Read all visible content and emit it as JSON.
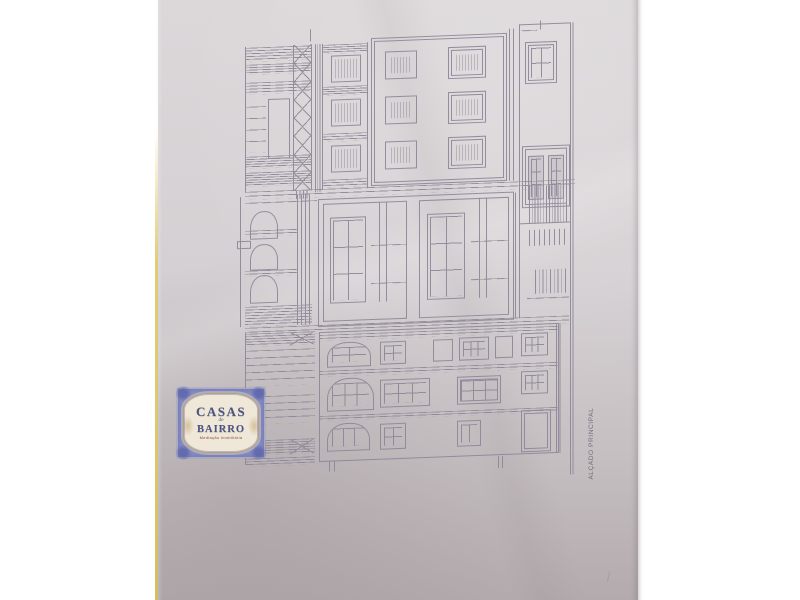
{
  "colors": {
    "background": "#ffffff",
    "paper_top": "#dcd8da",
    "paper_bottom": "#b1a9ab",
    "yellow": "#e2cd77",
    "line": "#8f8798",
    "label_text": "#6d6775",
    "stamp_frame": "#8a8fc2",
    "stamp_corner": "#5d66ab",
    "stamp_panel": "#efe8d8",
    "stamp_gold": "#bfa067",
    "stamp_text": "#4d5480",
    "stamp_tagline": "#8a4a40"
  },
  "stamp": {
    "title": "CASAS",
    "conjunction": "do",
    "subtitle": "BAIRRO",
    "tagline": "Mediação Imobiliária"
  },
  "drawing": {
    "label": "ALÇADO PRINCIPAL",
    "elements": [
      {
        "t": "box",
        "x": 2,
        "y": 2,
        "w": 70,
        "h": 146,
        "sides": "l"
      },
      {
        "t": "hl",
        "x": 2,
        "y": 3,
        "w": 66,
        "h": 14,
        "n": 5
      },
      {
        "t": "hl",
        "x": 2,
        "y": 20,
        "w": 66,
        "h": 10,
        "n": 4
      },
      {
        "t": "hl",
        "x": 2,
        "y": 38,
        "w": 66,
        "h": 12,
        "n": 4
      },
      {
        "t": "box",
        "x": 25,
        "y": 55,
        "w": 22,
        "h": 60
      },
      {
        "t": "hl",
        "x": 2,
        "y": 62,
        "w": 21,
        "h": 46,
        "n": 4
      },
      {
        "t": "hl",
        "x": 2,
        "y": 112,
        "w": 66,
        "h": 12,
        "n": 5
      },
      {
        "t": "hl",
        "x": 2,
        "y": 128,
        "w": 66,
        "h": 14,
        "n": 6
      },
      {
        "t": "x",
        "x": 50,
        "y": 2,
        "w": 19,
        "h": 146,
        "n": 8,
        "sides": "lr"
      },
      {
        "t": "vl",
        "x": 72,
        "y": 2,
        "w": 7,
        "h": 148,
        "n": 3
      },
      {
        "t": "vl",
        "x": 67,
        "y": -13,
        "w": 1,
        "h": 12,
        "n": 1
      },
      {
        "t": "box",
        "x": 79,
        "y": 2,
        "w": 46,
        "h": 146,
        "sides": "lr"
      },
      {
        "t": "hl",
        "x": 79,
        "y": 3,
        "w": 46,
        "h": 9,
        "n": 4
      },
      {
        "t": "box",
        "x": 88,
        "y": 14,
        "w": 30,
        "h": 27,
        "hv": 3,
        "pad": 3
      },
      {
        "t": "hl",
        "x": 79,
        "y": 45,
        "w": 46,
        "h": 9,
        "n": 4
      },
      {
        "t": "box",
        "x": 88,
        "y": 58,
        "w": 30,
        "h": 27,
        "hv": 3,
        "pad": 3
      },
      {
        "t": "hl",
        "x": 79,
        "y": 92,
        "w": 46,
        "h": 8,
        "n": 3
      },
      {
        "t": "box",
        "x": 88,
        "y": 104,
        "w": 30,
        "h": 27,
        "hv": 3,
        "pad": 3
      },
      {
        "t": "hl",
        "x": 79,
        "y": 138,
        "w": 46,
        "h": 8,
        "n": 3
      },
      {
        "t": "box",
        "x": 128,
        "y": -2,
        "w": 136,
        "h": 148,
        "dbl": 1
      },
      {
        "t": "box",
        "x": 142,
        "y": 12,
        "w": 32,
        "h": 28,
        "hv": 3,
        "pad": 5
      },
      {
        "t": "box",
        "x": 205,
        "y": 10,
        "w": 38,
        "h": 32,
        "dbl": 1,
        "hv": 3,
        "pad": 7
      },
      {
        "t": "box",
        "x": 142,
        "y": 57,
        "w": 32,
        "h": 28,
        "hv": 3,
        "pad": 5
      },
      {
        "t": "box",
        "x": 205,
        "y": 55,
        "w": 38,
        "h": 32,
        "dbl": 1,
        "hv": 3,
        "pad": 7
      },
      {
        "t": "box",
        "x": 142,
        "y": 102,
        "w": 32,
        "h": 28,
        "hv": 3,
        "pad": 5
      },
      {
        "t": "box",
        "x": 205,
        "y": 100,
        "w": 38,
        "h": 32,
        "dbl": 1,
        "hv": 3,
        "pad": 7
      },
      {
        "t": "vl",
        "x": 266,
        "y": -6,
        "w": 8,
        "h": 152,
        "n": 2
      },
      {
        "t": "box",
        "x": 276,
        "y": -10,
        "w": 52,
        "h": 200,
        "sides": "ltb"
      },
      {
        "t": "hl",
        "x": 278,
        "y": -4,
        "w": 16,
        "h": 1,
        "n": 1
      },
      {
        "t": "vl",
        "x": 297,
        "y": -13,
        "w": 1,
        "h": 9,
        "n": 1
      },
      {
        "t": "box",
        "x": 282,
        "y": 8,
        "w": 32,
        "h": 42,
        "dbl": 1,
        "cols": 2,
        "rows": 2,
        "pad": 5
      },
      {
        "t": "box",
        "x": 279,
        "y": 112,
        "w": 48,
        "h": 62,
        "dbl": 1
      },
      {
        "t": "box",
        "x": 285,
        "y": 122,
        "w": 16,
        "h": 44,
        "cols": 2,
        "rows": 3,
        "bg": 1
      },
      {
        "t": "box",
        "x": 305,
        "y": 122,
        "w": 16,
        "h": 44,
        "cols": 2,
        "rows": 3,
        "bg": 1
      },
      {
        "t": "vl",
        "x": 327,
        "y": -10,
        "w": 5,
        "h": 452,
        "n": 2
      },
      {
        "t": "hl",
        "x": 2,
        "y": 147,
        "w": 330,
        "h": 8,
        "n": 2
      },
      {
        "t": "vl",
        "x": 53,
        "y": 148,
        "w": 14,
        "h": 8,
        "n": 4
      },
      {
        "t": "hl",
        "x": 2,
        "y": 158,
        "w": 72,
        "h": 1,
        "n": 1
      },
      {
        "t": "arch",
        "x": 7,
        "y": 167,
        "w": 28,
        "h": 28
      },
      {
        "t": "box",
        "x": -6,
        "y": 196,
        "w": 14,
        "h": 8
      },
      {
        "t": "arch",
        "x": 7,
        "y": 200,
        "w": 28,
        "h": 26
      },
      {
        "t": "arch",
        "x": 7,
        "y": 231,
        "w": 28,
        "h": 28
      },
      {
        "t": "hl",
        "x": 2,
        "y": 186,
        "w": 52,
        "h": 6,
        "n": 2
      },
      {
        "t": "hl",
        "x": 2,
        "y": 226,
        "w": 52,
        "h": 6,
        "n": 2
      },
      {
        "t": "hl",
        "x": 2,
        "y": 262,
        "w": 67,
        "h": 20,
        "n": 7
      },
      {
        "t": "vl",
        "x": 54,
        "y": 152,
        "w": 16,
        "h": 130,
        "n": 4
      },
      {
        "t": "vl",
        "x": -3,
        "y": 152,
        "w": 1,
        "h": 130,
        "n": 1
      },
      {
        "t": "box",
        "x": 75,
        "y": 157,
        "w": 196,
        "h": 128
      },
      {
        "t": "box",
        "x": 80,
        "y": 162,
        "w": 84,
        "h": 118
      },
      {
        "t": "box",
        "x": 87,
        "y": 176,
        "w": 36,
        "h": 86,
        "cols": 2,
        "rows": 3
      },
      {
        "t": "vl",
        "x": 136,
        "y": 162,
        "w": 14,
        "h": 100,
        "n": 2
      },
      {
        "t": "hl",
        "x": 128,
        "y": 205,
        "w": 36,
        "h": 1,
        "n": 1
      },
      {
        "t": "hl",
        "x": 128,
        "y": 243,
        "w": 36,
        "h": 1,
        "n": 1
      },
      {
        "t": "box",
        "x": 176,
        "y": 162,
        "w": 90,
        "h": 118
      },
      {
        "t": "box",
        "x": 184,
        "y": 176,
        "w": 38,
        "h": 86,
        "cols": 2,
        "rows": 3
      },
      {
        "t": "vl",
        "x": 236,
        "y": 162,
        "w": 14,
        "h": 100,
        "n": 2
      },
      {
        "t": "hl",
        "x": 228,
        "y": 205,
        "w": 38,
        "h": 1,
        "n": 1
      },
      {
        "t": "hl",
        "x": 228,
        "y": 243,
        "w": 38,
        "h": 1,
        "n": 1
      },
      {
        "t": "vl",
        "x": 272,
        "y": 158,
        "w": 8,
        "h": 126,
        "n": 2
      },
      {
        "t": "vl",
        "x": 286,
        "y": 152,
        "w": 40,
        "h": 38,
        "n": 14
      },
      {
        "t": "vl",
        "x": 286,
        "y": 196,
        "w": 40,
        "h": 16,
        "n": 8
      },
      {
        "t": "vl",
        "x": 292,
        "y": 236,
        "w": 34,
        "h": 24,
        "n": 9
      },
      {
        "t": "hl",
        "x": 284,
        "y": 264,
        "w": 42,
        "h": 1,
        "n": 1
      },
      {
        "t": "hl",
        "x": 2,
        "y": 283,
        "w": 324,
        "h": 8,
        "n": 2
      },
      {
        "t": "box",
        "x": 2,
        "y": 288,
        "w": 70,
        "h": 132,
        "sides": "l"
      },
      {
        "t": "hl",
        "x": 2,
        "y": 289,
        "w": 70,
        "h": 13,
        "n": 5
      },
      {
        "t": "x",
        "x": 47,
        "y": 289,
        "w": 24,
        "h": 13,
        "n": 1
      },
      {
        "t": "hl",
        "x": 2,
        "y": 306,
        "w": 70,
        "h": 36,
        "n": 5
      },
      {
        "t": "hl",
        "x": 2,
        "y": 352,
        "w": 70,
        "h": 28,
        "n": 4
      },
      {
        "t": "hl",
        "x": 2,
        "y": 396,
        "w": 70,
        "h": 15,
        "n": 6
      },
      {
        "t": "x",
        "x": 47,
        "y": 396,
        "w": 24,
        "h": 15,
        "n": 1
      },
      {
        "t": "hl",
        "x": 2,
        "y": 414,
        "w": 70,
        "h": 8,
        "n": 3
      },
      {
        "t": "box",
        "x": 76,
        "y": 290,
        "w": 240,
        "h": 130
      },
      {
        "t": "hl",
        "x": 76,
        "y": 293,
        "w": 240,
        "h": 6,
        "n": 2
      },
      {
        "t": "arch",
        "x": 84,
        "y": 301,
        "w": 44,
        "h": 25,
        "cols": 2,
        "rows": 2,
        "pad": 4
      },
      {
        "t": "box",
        "x": 137,
        "y": 302,
        "w": 26,
        "h": 23,
        "cols": 2,
        "rows": 2,
        "pad": 3
      },
      {
        "t": "box",
        "x": 190,
        "y": 302,
        "w": 20,
        "h": 22
      },
      {
        "t": "box",
        "x": 216,
        "y": 301,
        "w": 30,
        "h": 23,
        "cols": 3,
        "rows": 2,
        "pad": 3
      },
      {
        "t": "box",
        "x": 252,
        "y": 301,
        "w": 18,
        "h": 22
      },
      {
        "t": "box",
        "x": 278,
        "y": 299,
        "w": 27,
        "h": 23,
        "cols": 3,
        "rows": 2,
        "pad": 3
      },
      {
        "t": "hl",
        "x": 76,
        "y": 329,
        "w": 240,
        "h": 6,
        "n": 2
      },
      {
        "t": "arch",
        "x": 84,
        "y": 337,
        "w": 47,
        "h": 33,
        "cols": 3,
        "rows": 2,
        "pad": 4
      },
      {
        "t": "box",
        "x": 137,
        "y": 340,
        "w": 50,
        "h": 28,
        "cols": 3,
        "rows": 2,
        "pad": 3
      },
      {
        "t": "box",
        "x": 214,
        "y": 340,
        "w": 44,
        "h": 28,
        "cols": 3,
        "rows": 2,
        "pad": 3,
        "dbl": 1
      },
      {
        "t": "box",
        "x": 278,
        "y": 337,
        "w": 27,
        "h": 23,
        "cols": 3,
        "rows": 2,
        "pad": 3
      },
      {
        "t": "hl",
        "x": 76,
        "y": 374,
        "w": 240,
        "h": 5,
        "n": 2
      },
      {
        "t": "arch",
        "x": 84,
        "y": 382,
        "w": 43,
        "h": 28,
        "cols": 3,
        "rows": 1,
        "pad": 4
      },
      {
        "t": "box",
        "x": 137,
        "y": 384,
        "w": 26,
        "h": 26,
        "cols": 2,
        "rows": 2,
        "pad": 3
      },
      {
        "t": "box",
        "x": 214,
        "y": 384,
        "w": 24,
        "h": 26,
        "cols": 2,
        "rows": 1,
        "pad": 3
      },
      {
        "t": "box",
        "x": 278,
        "y": 376,
        "w": 30,
        "h": 42,
        "dbl": 1
      },
      {
        "t": "vl",
        "x": 255,
        "y": 421,
        "w": 8,
        "h": 12,
        "n": 2
      },
      {
        "t": "vl",
        "x": 86,
        "y": 420,
        "w": 10,
        "h": 10,
        "n": 2
      },
      {
        "t": "vl",
        "x": 313,
        "y": 290,
        "w": 7,
        "h": 130,
        "n": 2
      }
    ]
  }
}
